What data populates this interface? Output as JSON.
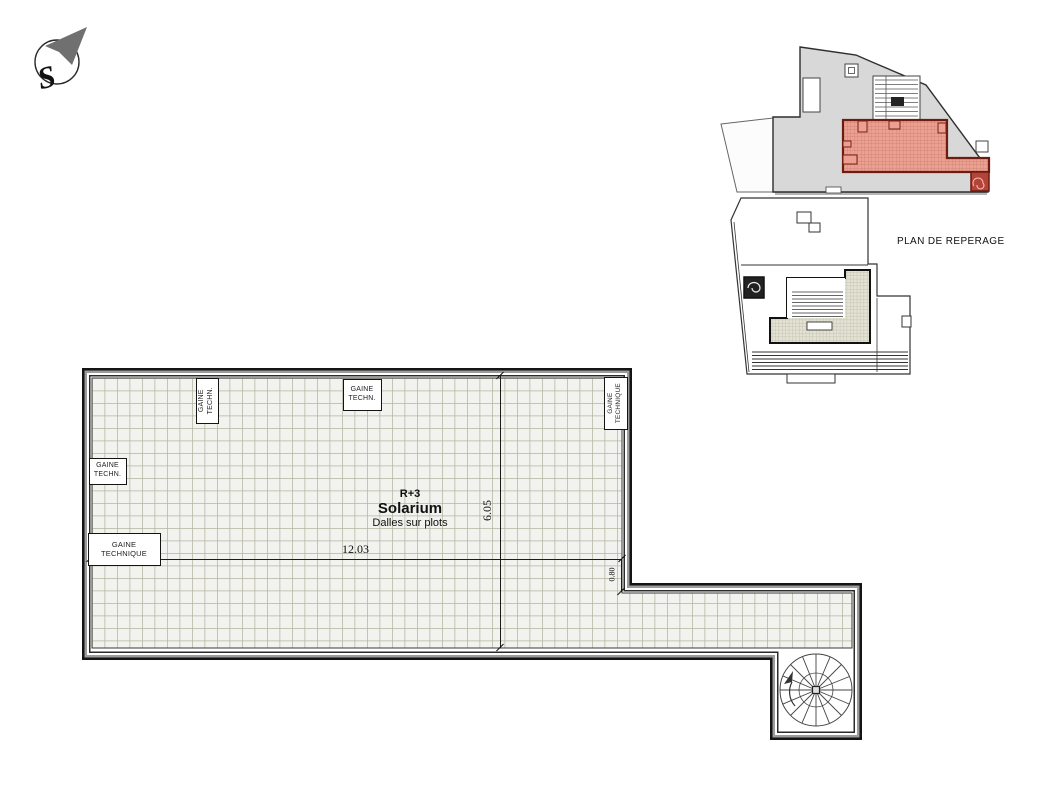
{
  "compass": {
    "label": "S"
  },
  "reference_map": {
    "title": "PLAN DE REPERAGE"
  },
  "main_plan": {
    "level": "R+3",
    "room_name": "Solarium",
    "room_subtitle": "Dalles sur plots",
    "dimensions": {
      "width": "12.03",
      "height": "6.05",
      "offset": "0.80"
    },
    "duct_labels": {
      "top_left_vertical": "GAINE\nTECHN.",
      "left_small": "GAINE\nTECHN.",
      "left_large": "GAINE\nTECHNIQUE",
      "top_center": "GAINE\nTECHN.",
      "top_right_vertical": "GAINE\nTECHNIQUE"
    }
  },
  "colors": {
    "highlight_red_fill": "#eba092",
    "highlight_red_line": "#cb7d6e",
    "highlight_red_border": "#6e1b10",
    "tile_background": "#f2f2ef",
    "tile_line": "#b5b5a2",
    "building_gray": "#d8d8d8",
    "terrace_beige": "#e3e2d3",
    "wall_black": "#141414",
    "wall_gray": "#9c9c9c"
  }
}
